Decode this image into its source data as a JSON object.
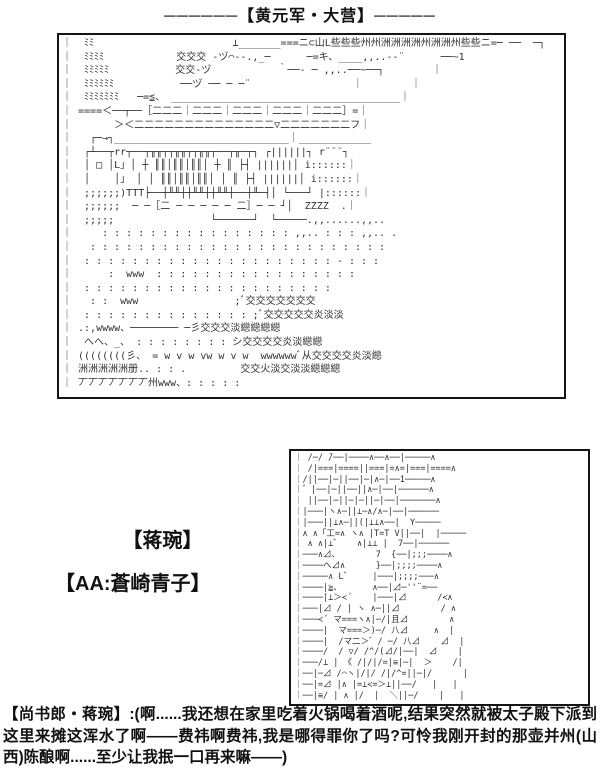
{
  "title": "──────【黄元军・大营】─────",
  "panel_camp": {
    "alt": "ascii-art-military-camp",
    "lines": [
      "｜  ﾐﾐ                       ⊥_______===ニ⊂山L些些些州州洲洲洲洲州洲洲州些些ニ=─ ──  ─┐",
      "｜  ﾐﾐﾐﾐ            交交交 ‐ヅ⌒‐-.,_─      ─=キ、____,,..-‐¨      ──~1",
      "｜  ﾐﾐﾐﾐﾐ           交交‐ヅ           ｀──‐ ─ ,,..──~──┐        ｜",
      "｜  ﾐﾐﾐﾐﾐﾐ           ──ヅ ── ─ ─¨                 ｜        ｜",
      "｜  ﾐﾐﾐﾐﾐﾐﾐ   ─=≦、 ______________________________________｜",
      "｜ ====＜──┬──［二二二｜二二二｜二二二｜二二二｜二二二］=｜",
      "｜       ＞＜二二二二二二二二二二二二二二▽二二二二二二二フ｜",
      "｜   ┌─→┐_____________________________｜____________",
      "｜  ┌┴──┬rr┬──┬╥╥┬┬╥╥┬┬╥╥┬──┬╥─┬┐ ┌||||||┐ r¨¨¨┐",
      "｜  │ □ │L」│ ┼ ║║│║║│║║│ ┼ ║ ├┤ ||||||│ i::::::｜",
      "｜  │    │」 │ │ ║║│║║│║║│ │ ║ ├┤ ||||||│ i::::::｜",
      "｜  ;;;;;;)TTT├──┼╨╨┼┼╨╨┼┼╨╨┼──┼╨─┤│ └───┘ |::::::｜",
      "｜  ;;;;;;  ─ ─［二 ─ ─ ─ ─ ─ 二］─ ─ ┘│  ZZZZ  .｜",
      "｜  ;;;;;                └──────┘  └─────.,,......,,..",
      "｜     : : : : : : : : : : : : : : : : ,,.. : : : ,,.. .",
      "｜   : : : : : : : : : : : : : : : : : : : : : : : : :",
      "｜  : : : : : : : : : : : : : : : : : : : : : ‐ : : :",
      "｜      :  www  : : : : : : : : : : : : : : : : :",
      "｜  : : : : : : : : : : : : : : : : : : : : :",
      "｜   : :  www                ;ﾞ交交交交交交交",
      "｜  : : : : : : : : : : : : : : ;ﾞ交交交交交炎淡淡",
      "｜ .:,wwww、──────── ─彡交交交淡纞纞纞纞",
      "｜  へへ、_、 : : : : : : : : シ交交交交炎淡纞纞",
      "｜ ((((((((彡、 = w v w vw w v w  wwwwwwﾞ从交交交交炎淡纞",
      "｜ 洲洲洲洲洲册.. : : .         交交火淡交淡淡纞纞纞",
      "｜ 丆丆丆丆丆丆丆州www、: : : : :"
    ]
  },
  "labels": {
    "character": "【蒋琬】",
    "aa_credit": "【AA:蒼崎青子】"
  },
  "panel_portrait": {
    "alt": "ascii-art-portrait-aozaki-aoko",
    "lines": [
      "｜ /─/ ̄/──|────∧──∧──|─────∧",
      "｜ /|===|====||===|=∧=|===|====∧",
      "｜/||──|─||──|─|∧─|──1─────∧",
      "｜゛|──|─||──||∧─|──|──────∧",
      "｜ ||──|─||─|─||─|──|───────∧",
      "｜|───|ヽ∧─||⊥─∧/∧─|──|──────",
      "｜|───||⊥∧─||(|⊥⊥∧──|  Y─────",
      "｜∧ ∧「工=∧ ヽ∧ |Т=Т V||──|  |─────",
      "｜ ∧ ∧|⊥゛   ∧|⊥⊥ |  7──|──────",
      "｜───∧⊿、       7  {──|;;;────∧",
      "｜────へ⊿∧      }──|;;;;────∧",
      "｜─────∧ L゛    |───|;;;;───∧",
      "｜────|≧、      ∧──|⊿─''¨=──",
      "｜────|⊥＞≺´    |───|⊿      /≺∧",
      "｜───|⊿ / | ヽ ∧─||⊿        / ∧",
      "｜───≺´ マ===ヽ∧|─/|且⊿        ∧",
      "｜────|  マ===＞)─/ 八⊿     ∧  |",
      "｜────|  /マ二＞゛/ ─/ 八⊿    ⊿  |",
      "｜────/  / ▽/ /^/(⊿/|──|  ⊿    |",
      "｜───/⊥ | 《 /|/|/=|≡|─|  ＞    /|",
      "｜──|─⊿ /⌒ヽ|/|/ /|/^=||─|/      |",
      "｜──|=⊿ |∧ |=⊥≺=＞⊥||──/   |   |",
      "｜──|≡/ | ∧ |/  |  ＼||─/    |   |"
    ]
  },
  "dialogue": "【尚书郎・蒋琬】:(啊......我还想在家里吃着火锅喝着酒呢,结果突然就被太子殿下派到这里来摊这浑水了啊——费祎啊费祎,我是哪得罪你了吗?可怜我刚开封的那壶并州(山西)陈酿啊......至少让我抿一口再来嘛——)",
  "colors": {
    "ink": "#111111",
    "art_ink": "#303030",
    "background": "#ffffff"
  }
}
